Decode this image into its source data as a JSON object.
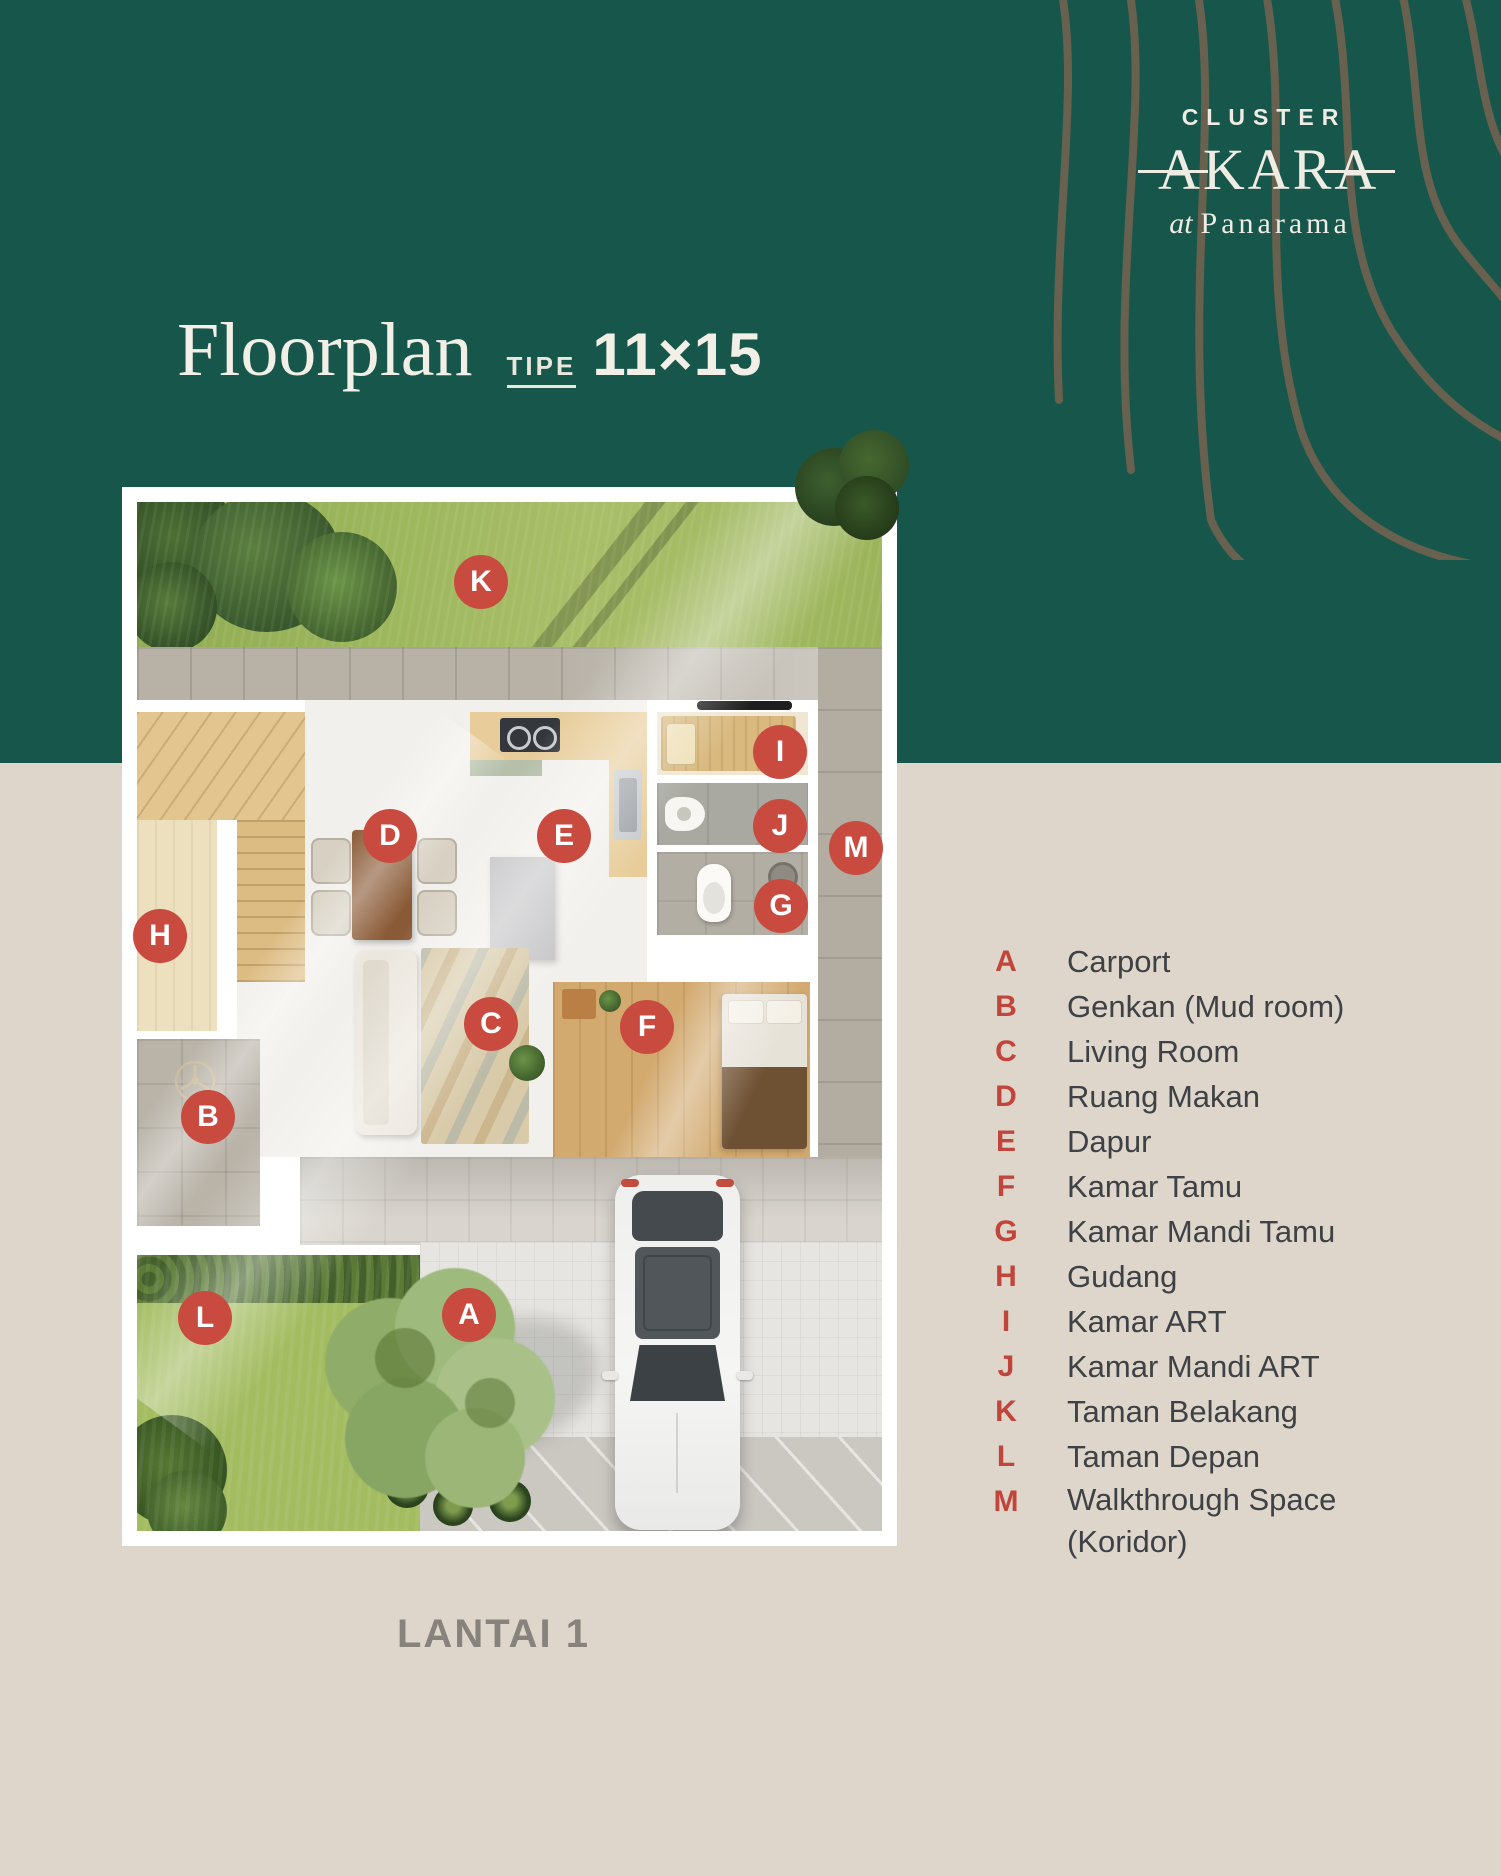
{
  "brand": {
    "cluster": "CLUSTER",
    "name": "AKARA",
    "tagline_prefix": "at",
    "tagline_name": "Panarama"
  },
  "title": {
    "main": "Floorplan",
    "type_label": "TIPE",
    "dimensions": "11×15"
  },
  "floor_label": "LANTAI 1",
  "legend": {
    "items": [
      {
        "letter": "A",
        "label": "Carport"
      },
      {
        "letter": "B",
        "label": "Genkan (Mud room)"
      },
      {
        "letter": "C",
        "label": "Living Room"
      },
      {
        "letter": "D",
        "label": "Ruang Makan"
      },
      {
        "letter": "E",
        "label": "Dapur"
      },
      {
        "letter": "F",
        "label": "Kamar Tamu"
      },
      {
        "letter": "G",
        "label": "Kamar Mandi Tamu"
      },
      {
        "letter": "H",
        "label": "Gudang"
      },
      {
        "letter": "I",
        "label": "Kamar ART"
      },
      {
        "letter": "J",
        "label": "Kamar Mandi ART"
      },
      {
        "letter": "K",
        "label": "Taman Belakang"
      },
      {
        "letter": "L",
        "label": "Taman Depan"
      },
      {
        "letter": "M",
        "label": "Walkthrough Space (Koridor)"
      }
    ]
  },
  "colors": {
    "header_green": "#17564A",
    "background_beige": "#DED6CA",
    "marker_red": "#C94A3F",
    "legend_letter_red": "#C2453B",
    "text_dark": "#3E4145",
    "floor_label_grey": "#87827C",
    "logo_cream": "#EFECE3",
    "contour_brown": "#7D6450"
  }
}
